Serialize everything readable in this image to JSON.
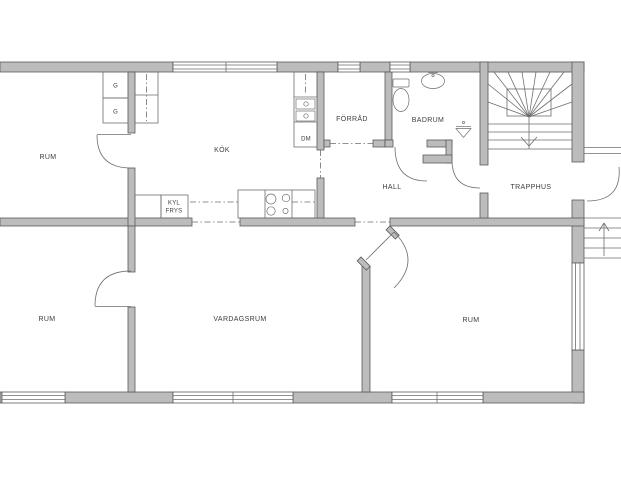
{
  "plan": {
    "rooms": {
      "rum_top_left": "RUM",
      "kok": "KÖK",
      "forrad": "FÖRRÅD",
      "badrum": "BADRUM",
      "hall": "HALL",
      "trapphus": "TRAPPHUS",
      "rum_bottom_left": "RUM",
      "vardagsrum": "VARDAGSRUM",
      "rum_bottom_right": "RUM"
    },
    "fixtures": {
      "wardrobe_1": "G",
      "wardrobe_2": "G",
      "fridge_line1": "KYL",
      "fridge_line2": "FRYS",
      "dishwasher": "DM"
    },
    "colors": {
      "background": "#ffffff",
      "wall_fill": "#bcbcbc",
      "wall_stroke": "#5a5a5a",
      "line": "#6e6e6e",
      "text": "#3d3d3d"
    }
  }
}
